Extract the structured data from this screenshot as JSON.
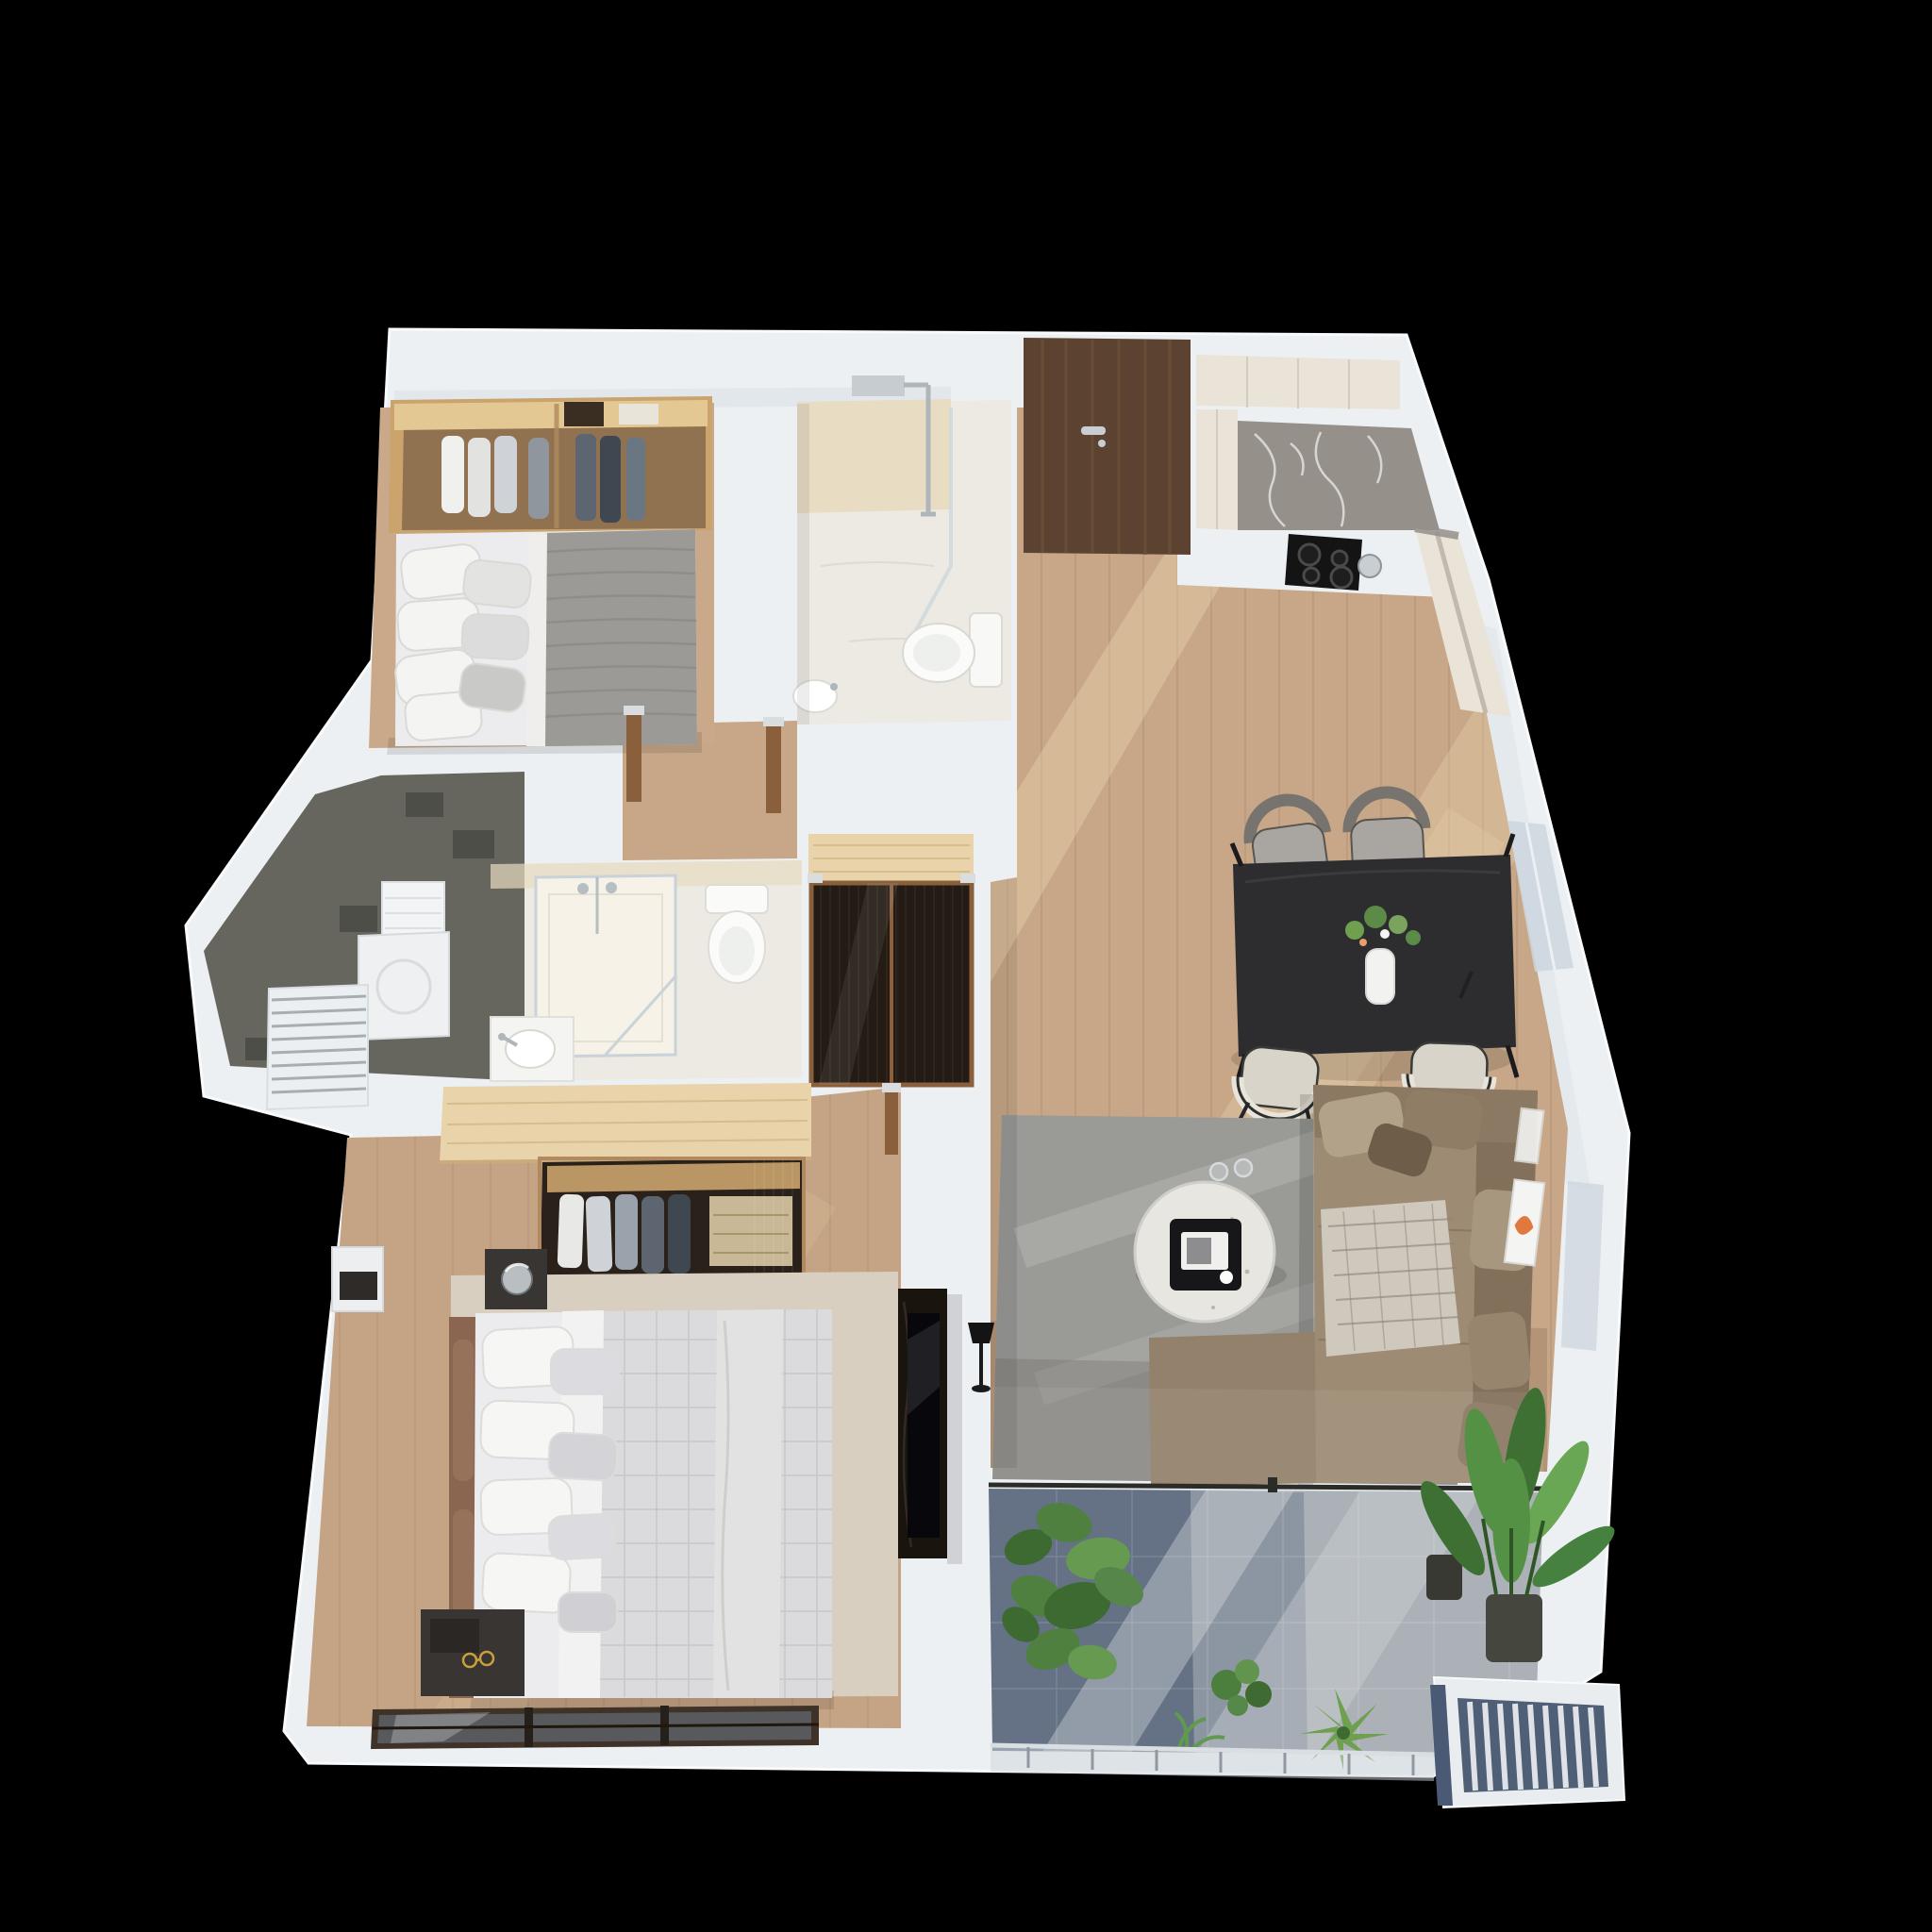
{
  "scene": {
    "type": "3d-top-down-apartment-floor-plan-render",
    "background": "#000000"
  },
  "palette": {
    "wall": "#edf0f3",
    "wall_stroke": "#f8fafc",
    "wall_shade": "#dde3e8",
    "wood_floor": "#c7a787",
    "wood_light": "#e9d2ac",
    "wood_dark": "#5a4030",
    "entry_door": "#5c4230",
    "door_handle": "#c9ced3",
    "marble": "#95908a",
    "marble_vein": "#e8e6e2",
    "cabinet_cream": "#eae4d8",
    "cooktop": "#141414",
    "bath_floor": "#eceae2",
    "bath_wall": "#e8dcc3",
    "fixture_white": "#fafaf8",
    "chrome": "#bcc3c8",
    "tile_gray": "#66665f",
    "closet_dark": "#241c14",
    "closet_wood": "#8a5f3c",
    "bulkhead_wood": "#e8d3ab",
    "wardrobe_glow": "#caa36d",
    "wardrobe_interior": "#2a211a",
    "rug_living": "#9a9a97",
    "rug_master": "#d9cfc1",
    "sofa": "#9d8b73",
    "sofa_dark": "#82705a",
    "throw_blanket": "#cfc8bc",
    "dining_table": "#2d2d2f",
    "chair_gray": "#a9a6a1",
    "chair_cream": "#d9d4c9",
    "bed_white": "#ececee",
    "duvet": "#dbdadc",
    "blanket_knit": "#9b9a97",
    "headboard": "#8a6650",
    "nightstand": "#383532",
    "media_wall": "#1a140f",
    "tv_screen": "#07070c",
    "balcony_light": "#abb1b7",
    "balcony_mid": "#7b8797",
    "balcony_shade": "#5d6b80",
    "glass": "#ccd6de",
    "rail": "#d9dee2",
    "plant": "#4c7a3a",
    "plant_light": "#6fa050",
    "plant_dark": "#3a622c",
    "ac_face": "#4e5f76",
    "ac_slat": "#dfe3e7",
    "gold": "#c9a13b"
  },
  "floor_plan": {
    "rooms": [
      {
        "name": "bedroom-2",
        "furniture": [
          "open-wardrobe",
          "double-bed"
        ]
      },
      {
        "name": "bathroom-1",
        "furniture": [
          "walk-in-shower",
          "toilet",
          "basin"
        ]
      },
      {
        "name": "entry-hall",
        "furniture": [
          "entrance-door"
        ]
      },
      {
        "name": "kitchen",
        "furniture": [
          "tall-cabinets",
          "marble-counter",
          "induction-cooktop",
          "kettle"
        ]
      },
      {
        "name": "dining-area",
        "furniture": [
          "dining-table",
          "dining-chairs",
          "flower-vase"
        ]
      },
      {
        "name": "living-room",
        "furniture": [
          "corner-sofa",
          "coffee-table",
          "area-rug",
          "tv-media-wall",
          "floor-lamp",
          "wall-art"
        ]
      },
      {
        "name": "bathroom-2",
        "furniture": [
          "glass-shower",
          "toilet",
          "vanity-basin"
        ]
      },
      {
        "name": "walk-through-closet",
        "furniture": [
          "reeded-glass-wardrobe"
        ]
      },
      {
        "name": "master-bedroom",
        "furniture": [
          "double-bed",
          "open-wardrobe",
          "nightstand",
          "table-lamp",
          "area-rug",
          "dresser",
          "sliding-balcony-door"
        ]
      },
      {
        "name": "utility-loggia",
        "furniture": [
          "washer-cabinet",
          "louvered-panel",
          "shelf"
        ]
      },
      {
        "name": "balcony",
        "furniture": [
          "potted-plants",
          "glass-balustrade",
          "ac-ledge"
        ]
      }
    ]
  }
}
